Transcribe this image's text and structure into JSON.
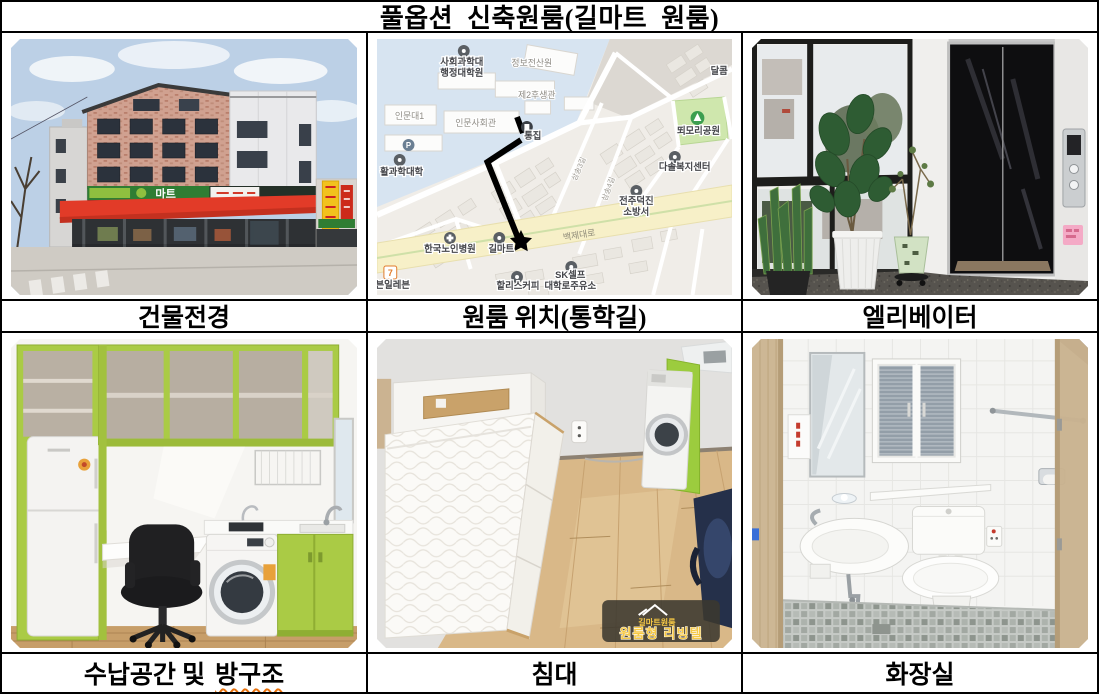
{
  "title": {
    "word1": "풀옵션",
    "word2": "신축원룸(길마트",
    "word3": "원룸)"
  },
  "captions": {
    "building": "건물전경",
    "map": "원룸 위치(통학길)",
    "elevator": "엘리베이터",
    "storage_prefix": "수납공간 및",
    "storage_marked": "방구조",
    "bed": "침대",
    "bathroom": "화장실"
  },
  "building_photo": {
    "mart_sign": "마트"
  },
  "map_photo": {
    "labels": {
      "grad_line1": "사회과학대",
      "grad_line2": "행정대학원",
      "info_center": "정보전산원",
      "welfare_hall": "제2후생관",
      "humanities1": "인문대1",
      "humanities_hall": "인문사회관",
      "science_college": "활과학대학",
      "tongzip": "통집",
      "dalkom": "달콤",
      "park": "뙤모리공원",
      "dasol_center": "다솔복지센터",
      "fire_line1": "전주덕진",
      "fire_line2": "소방서",
      "hospital": "한국노인병원",
      "gilmart": "길마트",
      "hollys": "할리스커피",
      "sk_line1": "SK셀프",
      "sk_line2": "대학로주유소",
      "seven_eleven": "븐일레븐",
      "seven_glyph": "7",
      "parking_glyph": "P",
      "road_main": "백제대로",
      "street1": "삼송3길",
      "street2": "삼송4길"
    }
  },
  "bed_photo": {
    "watermark_brand": "길마트원룸",
    "watermark_label": "원룸형 리빙텔"
  },
  "colors": {
    "spellcheck_underline": "#e8720c",
    "awning_red": "#e23b28",
    "cabinet_lime": "#aacb45",
    "map_road_yellow": "#f7f0c8",
    "map_campus_blue": "#d7e4f1",
    "watermark_yellow": "#f5c845"
  }
}
